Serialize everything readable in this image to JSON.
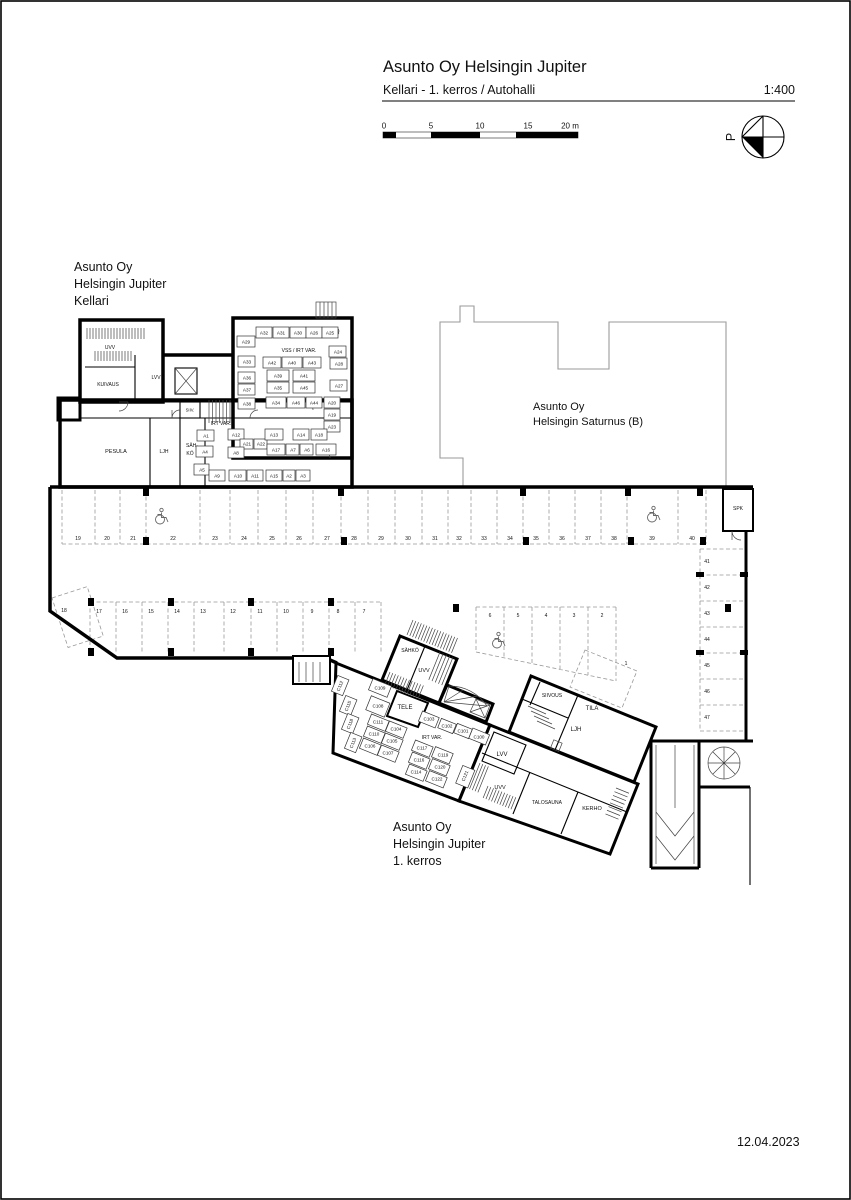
{
  "header": {
    "title": "Asunto Oy Helsingin Jupiter",
    "subtitle": "Kellari - 1. kerros / Autohalli",
    "scale": "1:400"
  },
  "scalebar": {
    "t0": "0",
    "t1": "5",
    "t2": "10",
    "t3": "15",
    "t4": "20 m"
  },
  "north": {
    "label": "P"
  },
  "footer": {
    "date": "12.04.2023"
  },
  "labels": {
    "kellari": {
      "l1": "Asunto Oy",
      "l2": "Helsingin Jupiter",
      "l3": "Kellari"
    },
    "saturnus": {
      "l1": "Asunto Oy",
      "l2": "Helsingin Saturnus (B)"
    },
    "kerros1": {
      "l1": "Asunto Oy",
      "l2": "Helsingin Jupiter",
      "l3": "1. kerros"
    }
  },
  "kellari": {
    "rooms": {
      "uvv": "UVV",
      "kuivaus": "KUIVAUS",
      "lvv": "LVV",
      "pesula": "PESULA",
      "ljh": "LJH",
      "sahko1": "SÄH-",
      "sahko2": "KÖ",
      "siiv": "SIIV.",
      "vss": "VSS / IRT VAR.",
      "irtvar": "IRT VAR."
    },
    "units": {
      "a1": "A1",
      "a2": "A2",
      "a3": "A3",
      "a4": "A4",
      "a5": "A5",
      "a6": "A6",
      "a7": "A7",
      "a8": "A8",
      "a9": "A9",
      "a10": "A10",
      "a11": "A11",
      "a12": "A12",
      "a13": "A13",
      "a14": "A14",
      "a15": "A15",
      "a16": "A16",
      "a17": "A17",
      "a18": "A18",
      "a19": "A19",
      "a20": "A20",
      "a21": "A21",
      "a22": "A22",
      "a23": "A23",
      "a24": "A24",
      "a25": "A25",
      "a26": "A26",
      "a27": "A27",
      "a28": "A28",
      "a29": "A29",
      "a30": "A30",
      "a31": "A31",
      "a32": "A32",
      "a33": "A33",
      "a34": "A34",
      "a35": "A35",
      "a36": "A36",
      "a37": "A37",
      "a38": "A38",
      "a39": "A39",
      "a40": "A40",
      "a41": "A41",
      "a42": "A42",
      "a43": "A43",
      "a44": "A44",
      "a45": "A45",
      "a46": "A46"
    }
  },
  "garage": {
    "spk": "SPK",
    "stalls": {
      "s1": "1",
      "s2": "2",
      "s3": "3",
      "s4": "4",
      "s5": "5",
      "s6": "6",
      "s7": "7",
      "s8": "8",
      "s9": "9",
      "s10": "10",
      "s11": "11",
      "s12": "12",
      "s13": "13",
      "s14": "14",
      "s15": "15",
      "s16": "16",
      "s17": "17",
      "s18": "18",
      "s19": "19",
      "s20": "20",
      "s21": "21",
      "s22": "22",
      "s23": "23",
      "s24": "24",
      "s25": "25",
      "s26": "26",
      "s27": "27",
      "s28": "28",
      "s29": "29",
      "s30": "30",
      "s31": "31",
      "s32": "32",
      "s33": "33",
      "s34": "34",
      "s35": "35",
      "s36": "36",
      "s37": "37",
      "s38": "38",
      "s39": "39",
      "s40": "40",
      "s41": "41",
      "s42": "42",
      "s43": "43",
      "s44": "44",
      "s45": "45",
      "s46": "46",
      "s47": "47"
    }
  },
  "kerros1": {
    "rooms": {
      "sahko": "SÄHKÖ",
      "uvv_top": "UVV",
      "tele": "TELE",
      "irtvar": "IRT VAR.",
      "lvv": "LVV",
      "uvv_bottom": "UVV",
      "siivous": "SIIVOUS",
      "tila": "TILA",
      "ljh": "LJH",
      "talosauna": "TALOSAUNA",
      "kerho": "KERHO"
    },
    "units": {
      "c100": "C100",
      "c101": "C101",
      "c102": "C102",
      "c103": "C103",
      "c104": "C104",
      "c105": "C105",
      "c106": "C106",
      "c107": "C107",
      "c108": "C108",
      "c109": "C109",
      "c110": "C110",
      "c111": "C111",
      "c112": "C112",
      "c113": "C113",
      "c114": "C114",
      "c115": "C115",
      "c116": "C116",
      "c117": "C117",
      "c118": "C118",
      "c119": "C119",
      "c120": "C120",
      "c121": "C121",
      "c122": "C122"
    }
  }
}
